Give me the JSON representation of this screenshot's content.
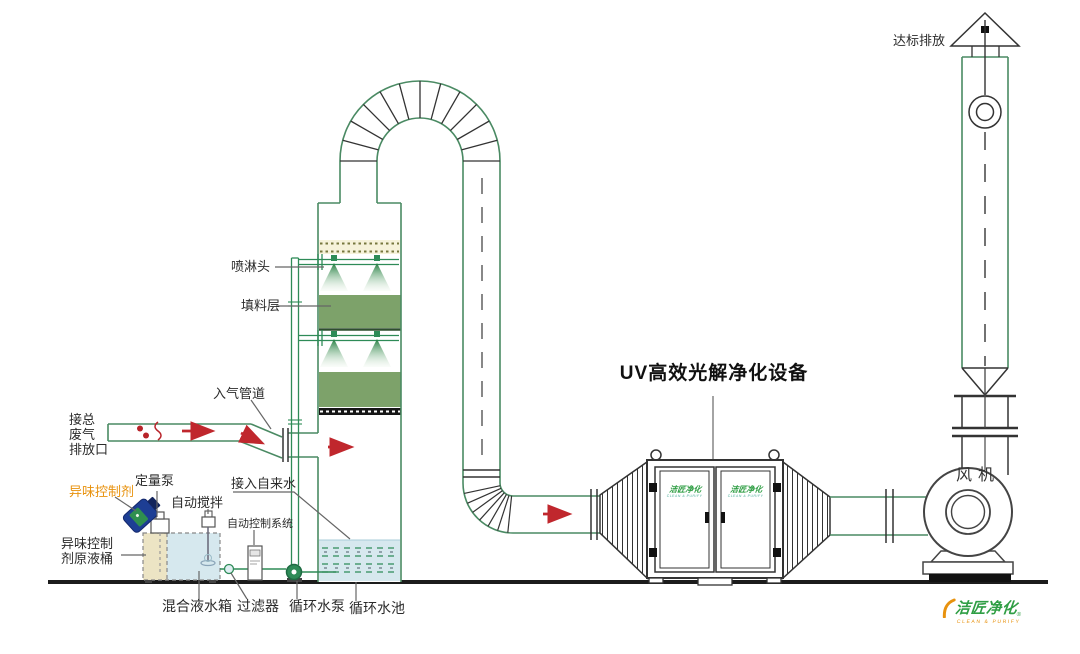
{
  "labels": {
    "discharge": "达标排放",
    "fan": "风机",
    "uv_title": "UV高效光解净化设备",
    "spray_head": "喷淋头",
    "packing_layer": "填料层",
    "inlet_duct": "入气管道",
    "waste_inlet": [
      "接总",
      "废气",
      "排放口"
    ],
    "odor_agent": "异味控制剂",
    "metering_pump": "定量泵",
    "auto_stirrer": "自动搅拌",
    "auto_control": "自动控制系统",
    "odor_tank": [
      "异味控制",
      "剂原液桶"
    ],
    "mixing_tank": "混合液水箱",
    "filter": "过滤器",
    "circulating_pump": "循环水泵",
    "circulating_pool": "循环水池",
    "tap_water": "接入自来水"
  },
  "logo": {
    "text": "洁匠净化",
    "subtext": "CLEAN & PURIFY",
    "reg": "®"
  },
  "door_logo": {
    "text": "洁匠净化",
    "subtext": "CLEAN & PURIFY"
  },
  "colors": {
    "pipe_green": "#2e8b57",
    "duct_green": "#4a8a63",
    "packing_green": "#7da26a",
    "nozzle_green": "#1e7a3c",
    "water_blue": "#d6e8ee",
    "cream": "#f6f2da",
    "flow_red": "#c0272d",
    "label_orange": "#e8920e",
    "logo_green": "#2f9e44",
    "line_dark": "#333333"
  }
}
